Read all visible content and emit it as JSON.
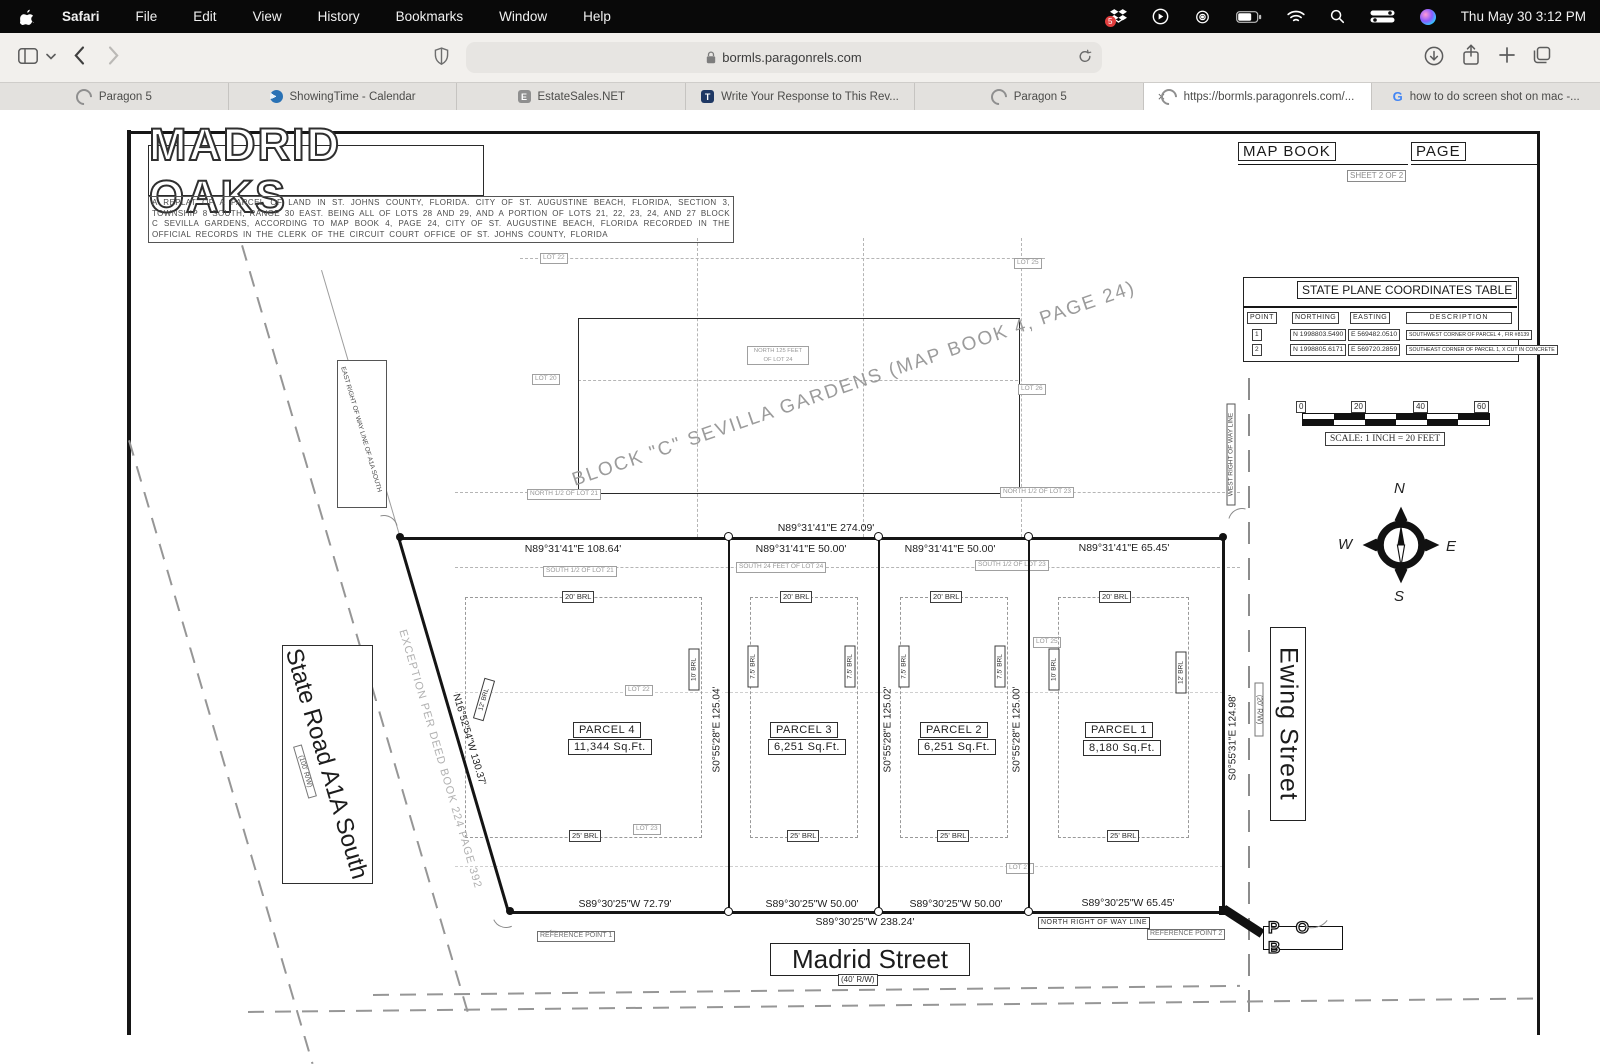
{
  "menubar": {
    "app": "Safari",
    "items": [
      "File",
      "Edit",
      "View",
      "History",
      "Bookmarks",
      "Window",
      "Help"
    ],
    "dropbox_badge": "5",
    "clock": "Thu May 30  3:12 PM"
  },
  "toolbar": {
    "url": "bormls.paragonrels.com"
  },
  "tabs": [
    {
      "label": "Paragon 5"
    },
    {
      "label": "ShowingTime - Calendar"
    },
    {
      "label": "EstateSales.NET",
      "icon_letter": "E"
    },
    {
      "label": "Write Your Response to This Rev...",
      "icon_letter": "T"
    },
    {
      "label": "Paragon 5"
    },
    {
      "label": "https://bormls.paragonrels.com/...",
      "close": "×"
    },
    {
      "label": "how to do screen shot on mac -...",
      "icon_letter": "G"
    }
  ],
  "plat": {
    "title": "MADRID OAKS",
    "description": "A REPLAT OF A PARCEL OF LAND IN ST. JOHNS COUNTY, FLORIDA. CITY OF ST. AUGUSTINE BEACH, FLORIDA, SECTION 3, TOWNSHIP 8 SOUTH, RANGE 30 EAST. BEING ALL OF LOTS 28 AND 29, AND A PORTION OF LOTS 21, 22, 23, 24, AND 27 BLOCK C SEVILLA GARDENS, ACCORDING TO MAP BOOK 4, PAGE 24, CITY OF ST. AUGUSTINE BEACH, FLORIDA RECORDED IN THE OFFICIAL RECORDS IN THE CLERK OF THE CIRCUIT COURT OFFICE OF ST. JOHNS COUNTY, FLORIDA",
    "map_book": "MAP BOOK",
    "page": "PAGE",
    "sheet": "SHEET 2 OF 2",
    "coords_table": {
      "title": "STATE PLANE COORDINATES TABLE",
      "headers": [
        "POINT",
        "NORTHING",
        "EASTING",
        "DESCRIPTION"
      ],
      "rows": [
        {
          "point": "1",
          "northing": "N 1998803.5490",
          "easting": "E 569482.0510",
          "description": "SOUTHWEST CORNER OF PARCEL 4 , FIR #8139"
        },
        {
          "point": "2",
          "northing": "N 1998805.6171",
          "easting": "E 569720.2859",
          "description": "SOUTHEAST CORNER OF PARCEL 1, X CUT IN CONCRETE"
        }
      ]
    },
    "scale_bar": {
      "ticks": [
        "0",
        "20",
        "40",
        "60"
      ],
      "label": "SCALE: 1 INCH = 20 FEET"
    },
    "compass": {
      "north": "N",
      "south": "S",
      "east": "E",
      "west": "W"
    },
    "streets": {
      "madrid": "Madrid Street",
      "madrid_rw": "(40' R/W)",
      "ewing": "Ewing Street",
      "ewing_rw": "(20' R/W)",
      "a1a": "State Road A1A South",
      "a1a_rw": "(100' R/W)"
    },
    "row_labels": {
      "north_row": "NORTH RIGHT OF WAY LINE",
      "west_row": "WEST RIGHT OF WAY LINE",
      "east_row_a1a": "EAST RIGHT OF WAY LINE OF A1A SOUTH"
    },
    "reference_points": {
      "rp1": "REFERENCE POINT 1",
      "rp2": "REFERENCE POINT 2",
      "pob": "P O B"
    },
    "block_label": "BLOCK \"C\" SEVILLA GARDENS (MAP BOOK 4, PAGE 24)",
    "exception_label": "EXCEPTION PER DEED BOOK 224 PAGE 392",
    "bearings": {
      "top_total": "N89°31'41\"E  274.09'",
      "top_p4": "N89°31'41\"E  108.64'",
      "top_p3": "N89°31'41\"E  50.00'",
      "top_p2": "N89°31'41\"E  50.00'",
      "top_p1": "N89°31'41\"E  65.45'",
      "bottom_p4": "S89°30'25\"W  72.79'",
      "bottom_p3": "S89°30'25\"W  50.00'",
      "bottom_p2": "S89°30'25\"W  50.00'",
      "bottom_p1": "S89°30'25\"W  65.45'",
      "bottom_total": "S89°30'25\"W  238.24'",
      "west_diag": "N16°52'54\"W  130.37'",
      "div_43": "S0°55'28\"E  125.04'",
      "div_32": "S0°55'28\"E  125.02'",
      "div_21": "S0°55'28\"E  125.00'",
      "east_line": "S0°55'31\"E  124.98'"
    },
    "parcels": [
      {
        "name": "PARCEL 4",
        "area": "11,344  Sq.Ft."
      },
      {
        "name": "PARCEL 3",
        "area": "6,251  Sq.Ft."
      },
      {
        "name": "PARCEL 2",
        "area": "6,251  Sq.Ft."
      },
      {
        "name": "PARCEL 1",
        "area": "8,180  Sq.Ft."
      }
    ],
    "brl": {
      "b20": "20' BRL",
      "b25": "25' BRL",
      "b75": "7.5' BRL",
      "b10": "10' BRL",
      "b12": "12' BRL"
    },
    "lot_labels": {
      "lot22_top": "LOT 22",
      "lot25_top": "LOT 25",
      "n125_lot24": "NORTH 125 FEET OF LOT 24",
      "lot20": "LOT 20",
      "lot26": "LOT 26",
      "n_half_lot21": "NORTH 1/2 OF LOT 21",
      "n_half_lot23": "NORTH 1/2 OF LOT 23",
      "s_half_lot21": "SOUTH 1/2 OF LOT 21",
      "s24_lot24": "SOUTH 24 FEET OF LOT 24",
      "s_half_lot23": "SOUTH 1/2 OF LOT 23",
      "lot22_mid": "LOT 22",
      "lot23_mid": "LOT 23",
      "lot25_mid": "LOT 25",
      "lot27_mid": "LOT 27"
    }
  }
}
